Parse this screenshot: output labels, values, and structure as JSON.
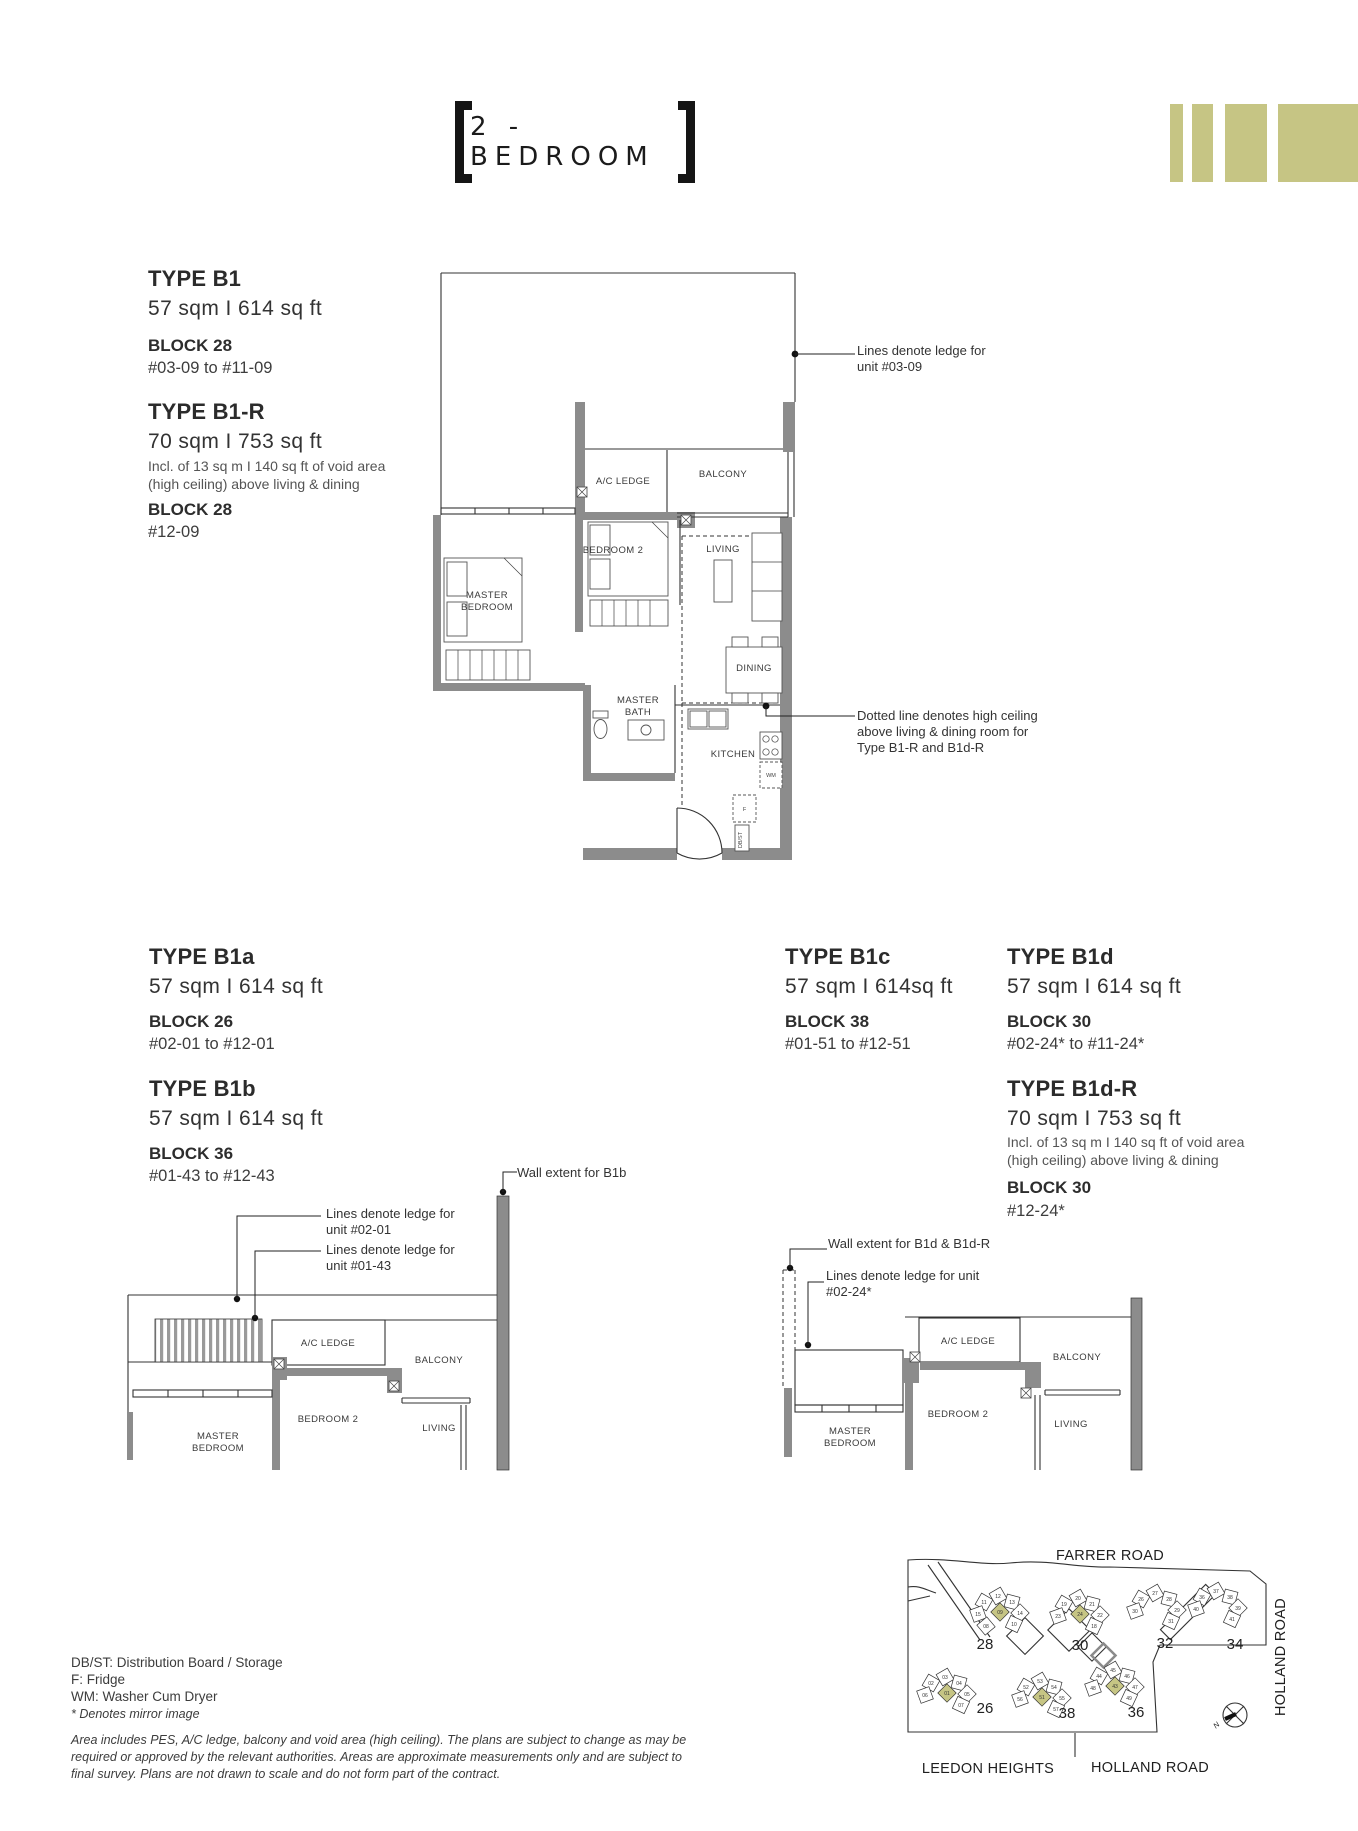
{
  "header": {
    "title": "2 - BEDROOM"
  },
  "types": {
    "b1": {
      "name": "TYPE B1",
      "area": "57 sqm  I  614 sq ft",
      "block": "BLOCK 28",
      "units": "#03-09 to #11-09"
    },
    "b1r": {
      "name": "TYPE B1-R",
      "area": "70 sqm  I  753 sq ft",
      "note1": "Incl. of 13 sq m I 140 sq ft of void area",
      "note2": "(high ceiling) above living & dining",
      "block": "BLOCK 28",
      "units": "#12-09"
    },
    "b1a": {
      "name": "TYPE B1a",
      "area": "57 sqm  I  614 sq ft",
      "block": "BLOCK 26",
      "units": "#02-01 to #12-01"
    },
    "b1b": {
      "name": "TYPE B1b",
      "area": "57 sqm  I  614 sq ft",
      "block": "BLOCK 36",
      "units": "#01-43 to #12-43"
    },
    "b1c": {
      "name": "TYPE B1c",
      "area": "57 sqm  I  614sq ft",
      "block": "BLOCK 38",
      "units": "#01-51 to #12-51"
    },
    "b1d": {
      "name": "TYPE B1d",
      "area": "57 sqm  I  614 sq ft",
      "block": "BLOCK 30",
      "units": "#02-24* to #11-24*"
    },
    "b1dr": {
      "name": "TYPE B1d-R",
      "area": "70 sqm  I  753 sq ft",
      "note1": "Incl. of 13 sq m I 140 sq ft of void area",
      "note2": "(high ceiling) above living & dining",
      "block": "BLOCK 30",
      "units": "#12-24*"
    }
  },
  "annotations": {
    "ledge0309": {
      "l1": "Lines denote ledge for",
      "l2": "unit #03-09"
    },
    "highceil": {
      "l1": "Dotted line denotes high ceiling",
      "l2": "above living & dining room for",
      "l3": "Type B1-R and B1d-R"
    },
    "wall_b1b": "Wall extent for B1b",
    "ledge0201": {
      "l1": "Lines denote ledge for",
      "l2": "unit #02-01"
    },
    "ledge0143": {
      "l1": "Lines denote ledge for",
      "l2": "unit #01-43"
    },
    "wall_b1d": "Wall extent for B1d & B1d-R",
    "ledge0224": {
      "l1": "Lines denote ledge for unit",
      "l2": "#02-24*"
    }
  },
  "rooms": {
    "master": "MASTER",
    "bedroom": "BEDROOM",
    "bath": "BATH",
    "bedroom2": "BEDROOM 2",
    "ac_ledge": "A/C LEDGE",
    "balcony": "BALCONY",
    "living": "LIVING",
    "dining": "DINING",
    "kitchen": "KITCHEN",
    "wm": "WM",
    "f": "F",
    "dbst": "DB/ST"
  },
  "site_map": {
    "farrer_road": "FARRER ROAD",
    "holland_road_side": "HOLLAND ROAD",
    "holland_road_bottom": "HOLLAND ROAD",
    "leedon_heights": "LEEDON HEIGHTS",
    "north": "N",
    "blocks": [
      {
        "label": "28",
        "cx": 230,
        "cy": 80,
        "lx": 215,
        "ly": 114,
        "units": [
          "11",
          "12",
          "13",
          "14",
          "15",
          "10",
          "08"
        ],
        "highlight": "09"
      },
      {
        "label": "30",
        "cx": 310,
        "cy": 82,
        "lx": 310,
        "ly": 115,
        "units": [
          "19",
          "20",
          "21",
          "22",
          "23",
          "18"
        ],
        "highlight": "24"
      },
      {
        "label": "32",
        "cx": 387,
        "cy": 77,
        "lx": 395,
        "ly": 113,
        "units": [
          "26",
          "27",
          "28",
          "29",
          "30",
          "31"
        ],
        "highlight": null
      },
      {
        "label": "34",
        "cx": 448,
        "cy": 75,
        "lx": 465,
        "ly": 114,
        "units": [
          "36",
          "37",
          "38",
          "39",
          "40",
          "41"
        ],
        "highlight": null
      },
      {
        "label": "26",
        "cx": 177,
        "cy": 161,
        "lx": 215,
        "ly": 178,
        "units": [
          "02",
          "03",
          "04",
          "05",
          "06",
          "07"
        ],
        "highlight": "01"
      },
      {
        "label": "38",
        "cx": 272,
        "cy": 165,
        "lx": 297,
        "ly": 183,
        "units": [
          "52",
          "53",
          "54",
          "55",
          "56",
          "57"
        ],
        "highlight": "51"
      },
      {
        "label": "36",
        "cx": 345,
        "cy": 154,
        "lx": 366,
        "ly": 182,
        "units": [
          "44",
          "45",
          "46",
          "47",
          "48",
          "49"
        ],
        "highlight": "43"
      }
    ]
  },
  "legend": {
    "l1": "DB/ST: Distribution Board / Storage",
    "l2": "F: Fridge",
    "l3": "WM: Washer Cum Dryer",
    "mirror": "* Denotes mirror image",
    "d1": "Area includes PES, A/C ledge, balcony and void area (high ceiling). The plans are subject to change as may be",
    "d2": "required or approved by the relevant authorities. Areas are approximate measurements only and are subject to",
    "d3": "final survey. Plans are not drawn to scale and do not form part of the contract."
  },
  "colors": {
    "accent": "#c6c584",
    "wall": "#8c8c8c",
    "line": "#333333"
  }
}
